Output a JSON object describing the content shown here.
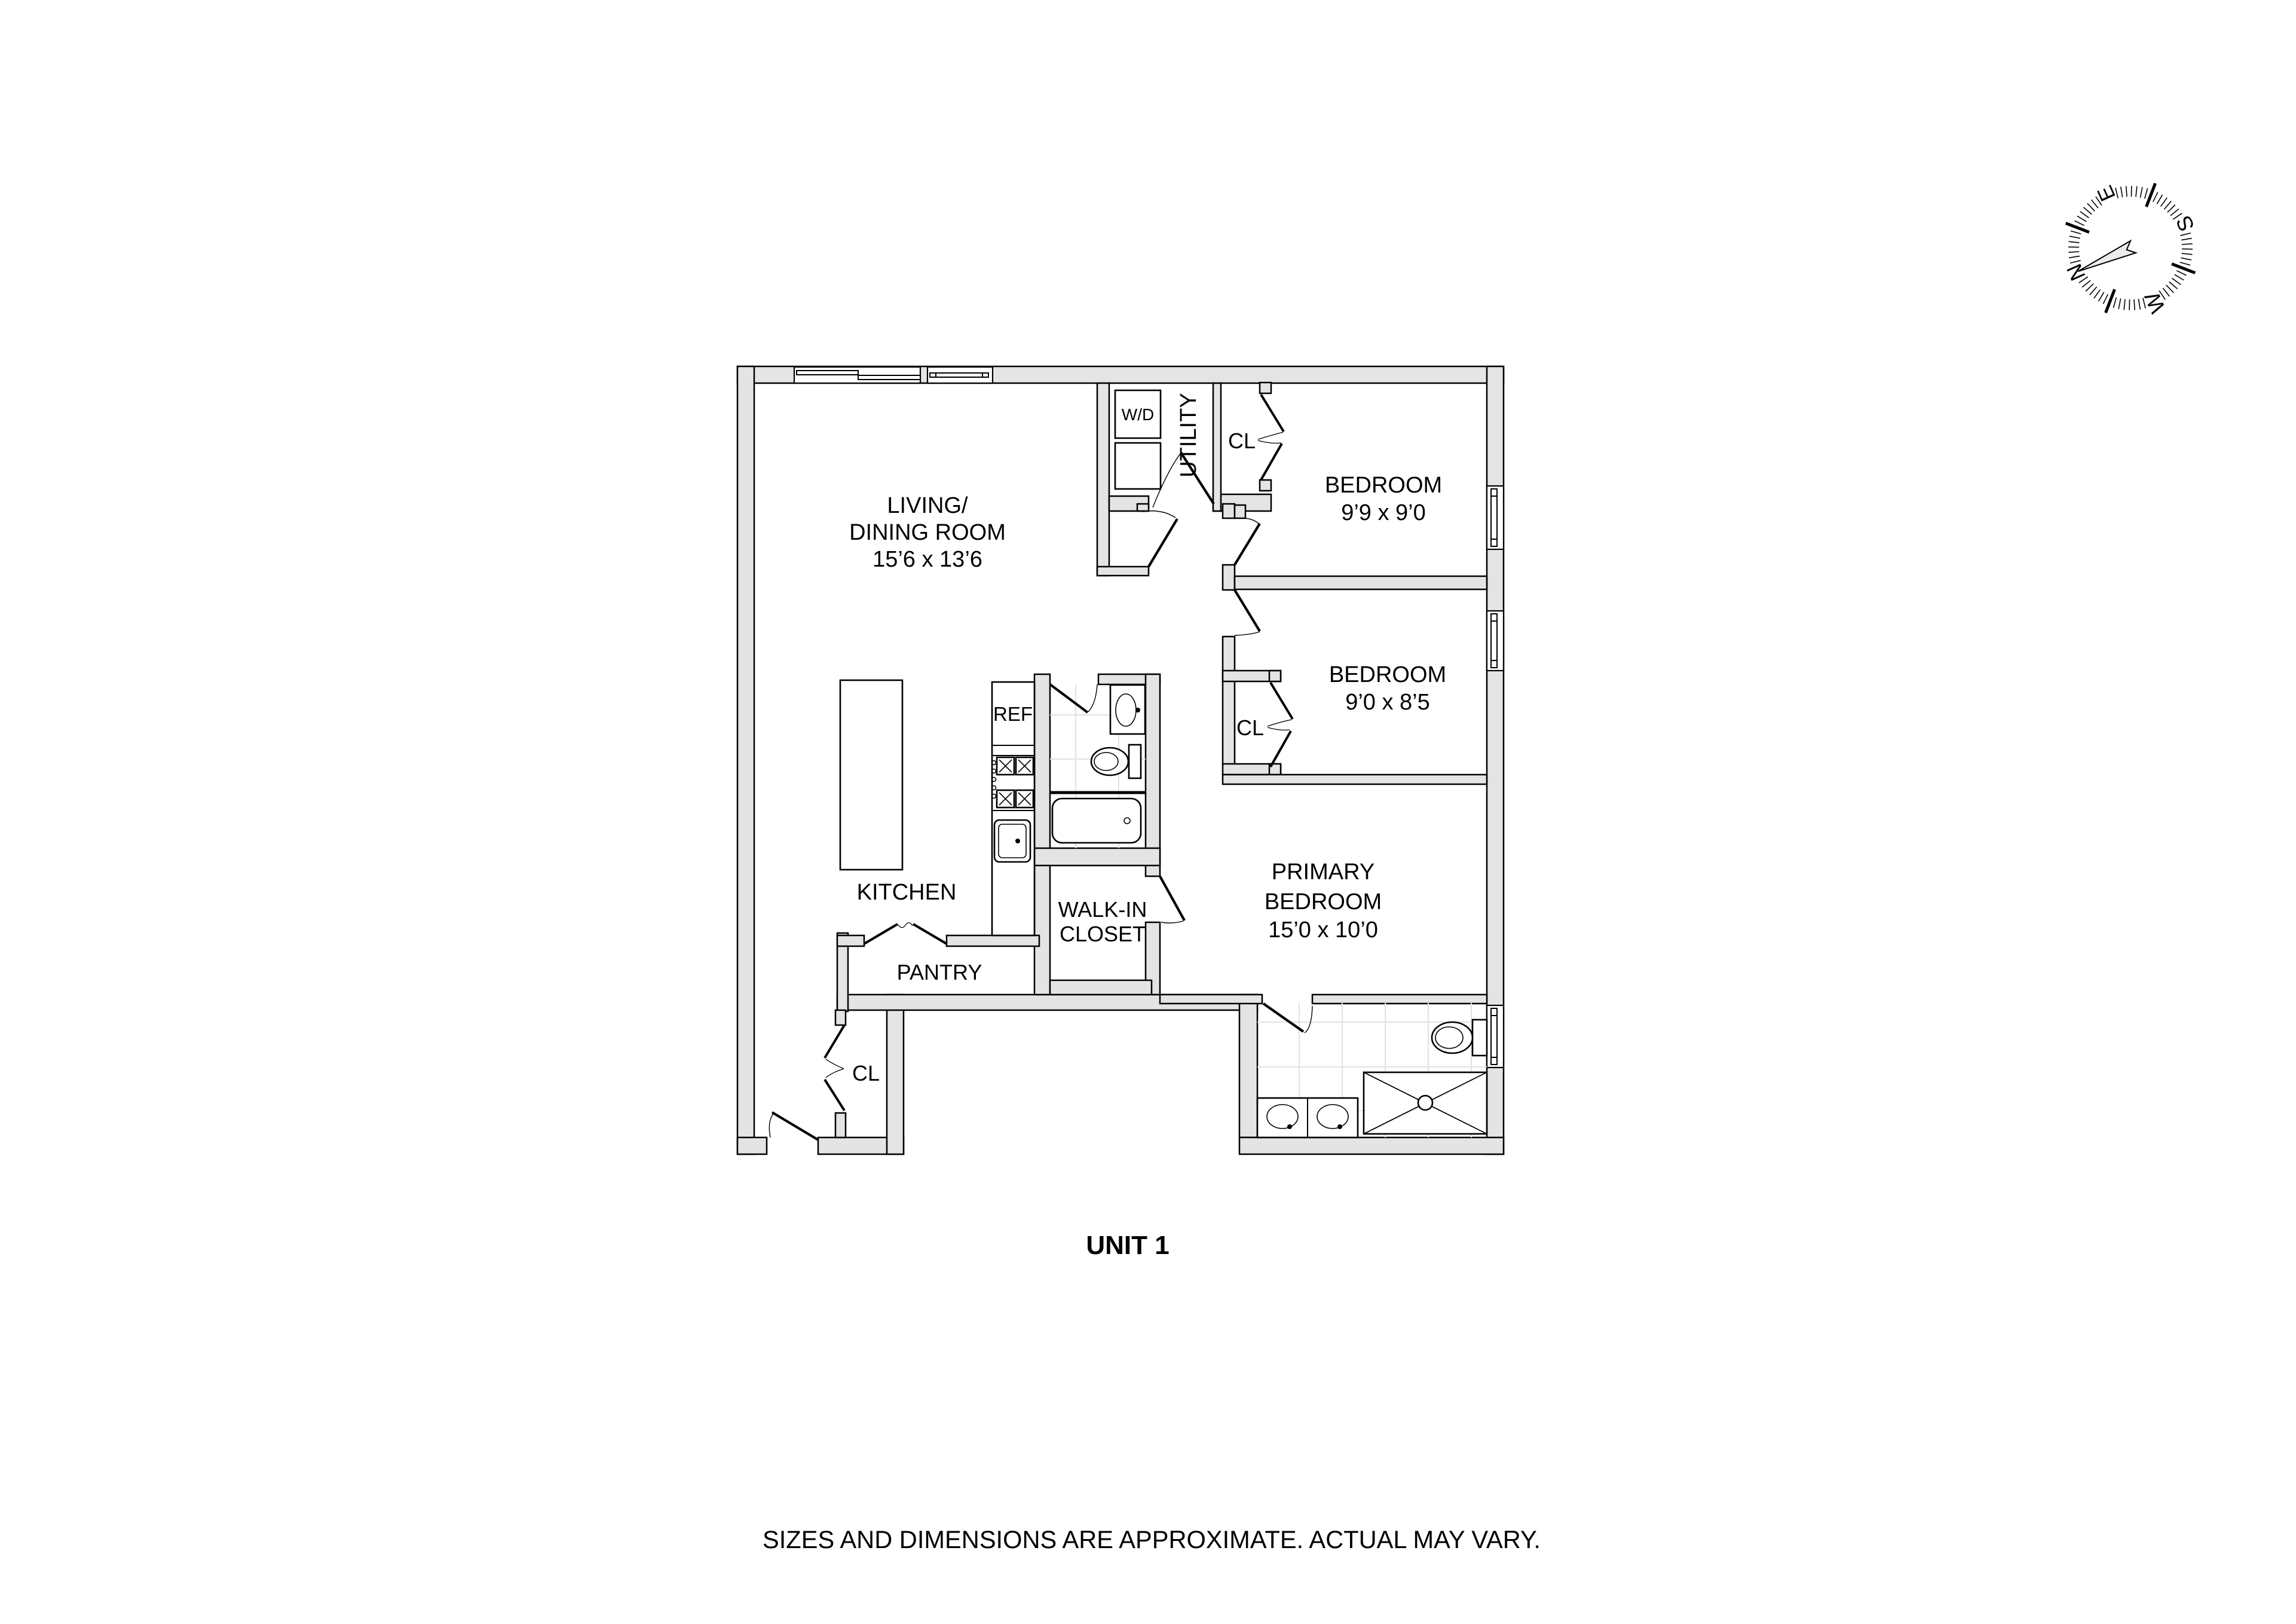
{
  "unit": {
    "label": "UNIT 1"
  },
  "footer": {
    "disclaimer": "SIZES AND DIMENSIONS ARE APPROXIMATE. ACTUAL MAY VARY."
  },
  "compass": {
    "north": "N",
    "south": "S",
    "east": "E",
    "west": "W"
  },
  "rooms": {
    "living_dining": {
      "lines": [
        "LIVING/",
        "DINING ROOM",
        "15’6 x 13’6"
      ]
    },
    "bedroom1": {
      "name": "BEDROOM",
      "dims": "9’9 x 9’0"
    },
    "bedroom2": {
      "name": "BEDROOM",
      "dims": "9’0 x 8’5"
    },
    "primary_bedroom": {
      "lines": [
        "PRIMARY",
        "BEDROOM",
        "15’0 x 10’0"
      ]
    },
    "kitchen": {
      "name": "KITCHEN"
    },
    "pantry": {
      "name": "PANTRY"
    },
    "walk_in_closet": {
      "lines": [
        "WALK-IN",
        "CLOSET"
      ]
    },
    "utility": {
      "name": "UTILITY"
    },
    "closet_bedroom1": {
      "name": "CL"
    },
    "closet_bedroom2": {
      "name": "CL"
    },
    "closet_entry": {
      "name": "CL"
    }
  },
  "fixtures": {
    "washer_dryer": "W/D",
    "refrigerator": "REF"
  },
  "colors": {
    "wall_fill": "#e4e4e4",
    "outline": "#000000",
    "tile_line": "#e2e2e2",
    "needle_fill": "#ececec",
    "background": "#ffffff"
  }
}
